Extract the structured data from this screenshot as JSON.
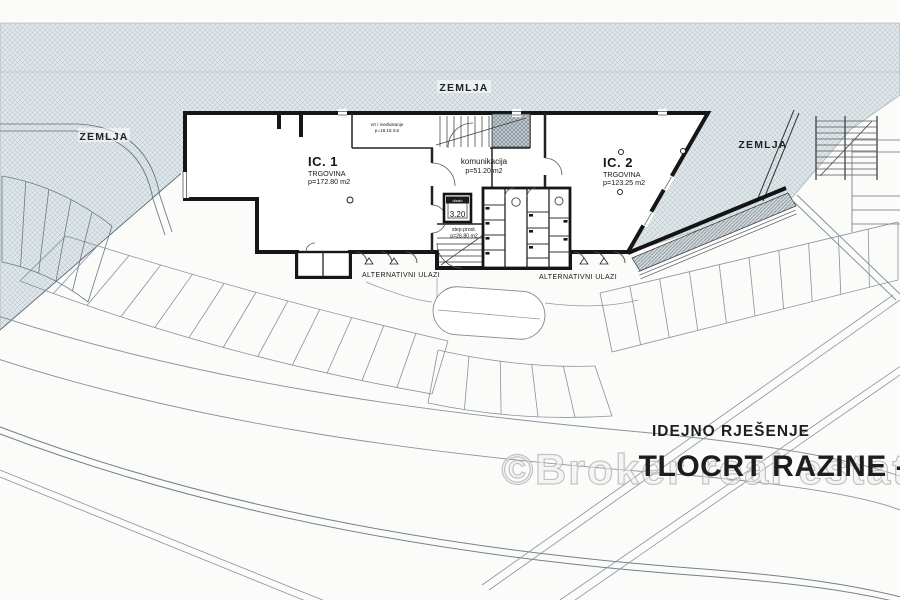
{
  "plan": {
    "ground_label_top": "ZEMLJA",
    "ground_label_left": "ZEMLJA",
    "ground_label_right": "ZEMLJA",
    "unit1": {
      "id": "IC. 1",
      "use": "TRGOVINA",
      "area": "p=172.80 m2"
    },
    "unit2": {
      "id": "IC. 2",
      "use": "TRGOVINA",
      "area": "p=123.25 m2"
    },
    "circulation": {
      "name": "komunikacija",
      "area": "p=51.20 m2"
    },
    "garden": {
      "name": "vrt / međustanje",
      "area": "p=18.15 m2"
    },
    "elevator": {
      "name": "dizalo",
      "size": "3.20"
    },
    "staircase": {
      "name": "step.prost.",
      "area": "p=26.80 m2"
    },
    "entrances_left": "ALTERNATIVNI ULAZI",
    "entrances_right": "ALTERNATIVNI ULAZI"
  },
  "title_block": {
    "project_phase": "IDEJNO RJEŠENJE",
    "drawing_title": "TLOCRT RAZINE -1"
  },
  "watermark": "©Broker real estate",
  "colors": {
    "hatch_bg": "#dfe6e9",
    "hatch_line": "#b6c3c9",
    "ramp_hatch_bg": "#cfd7da",
    "wall": "#161616",
    "parking_line": "#8593a0",
    "page": "#fbfbfa"
  }
}
